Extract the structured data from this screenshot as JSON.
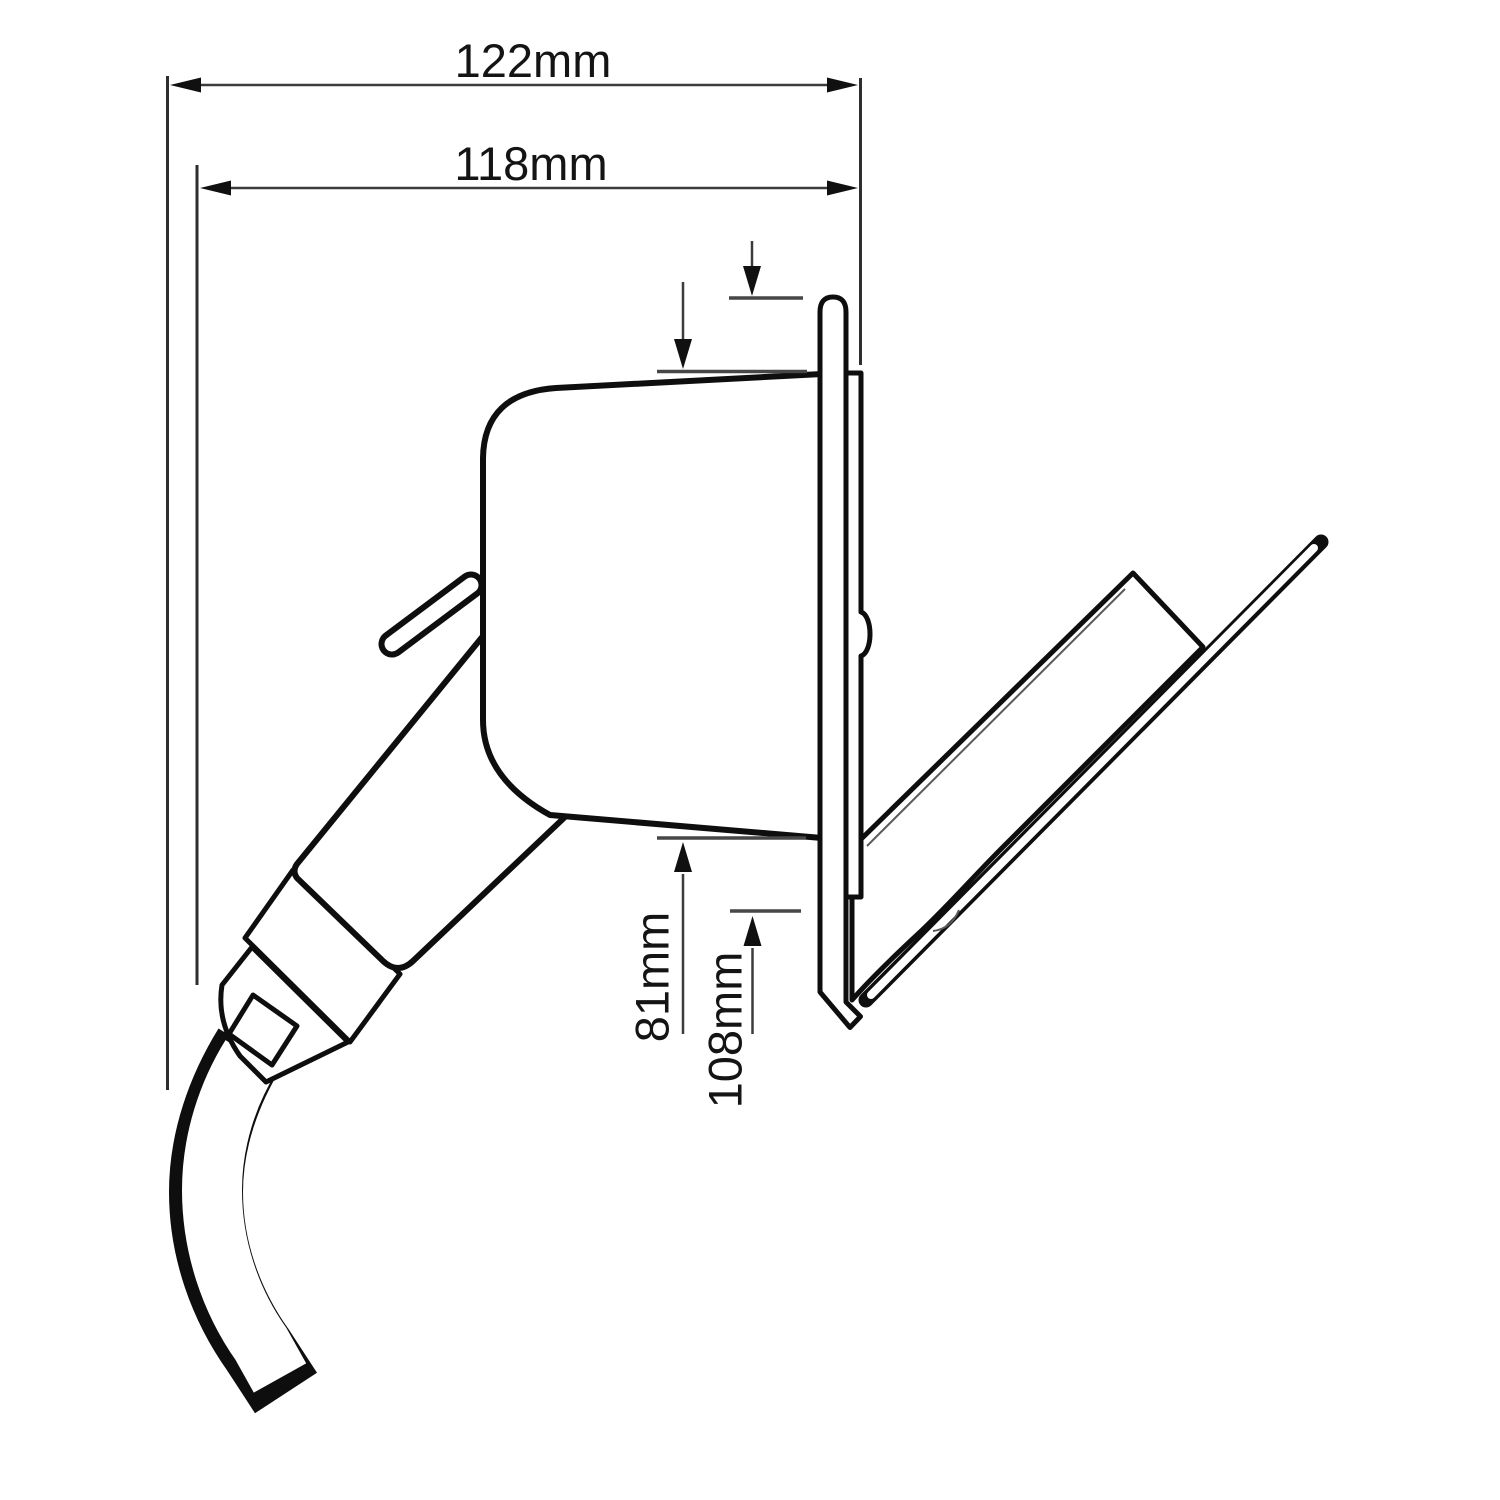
{
  "drawing": {
    "title": "Flush-mount mains inlet socket with plug and cable — side elevation",
    "type": "technical-line-drawing",
    "background_color": "#ffffff",
    "line_color": "#0e0e0e",
    "dimensions": {
      "overall_width": {
        "label": "122mm",
        "orientation": "horizontal"
      },
      "recess_width": {
        "label": "118mm",
        "orientation": "horizontal"
      },
      "body_height": {
        "label": "81mm",
        "orientation": "vertical-rotated"
      },
      "flange_height": {
        "label": "108mm",
        "orientation": "vertical-rotated"
      }
    },
    "parts": [
      "mounting-plate",
      "rear-flange",
      "socket-body",
      "latch-lever",
      "plug-grip",
      "ferrule-collar",
      "cable-gland",
      "strain-relief-square",
      "cable",
      "hinged-lid-dome",
      "lid-cover-blade"
    ]
  }
}
